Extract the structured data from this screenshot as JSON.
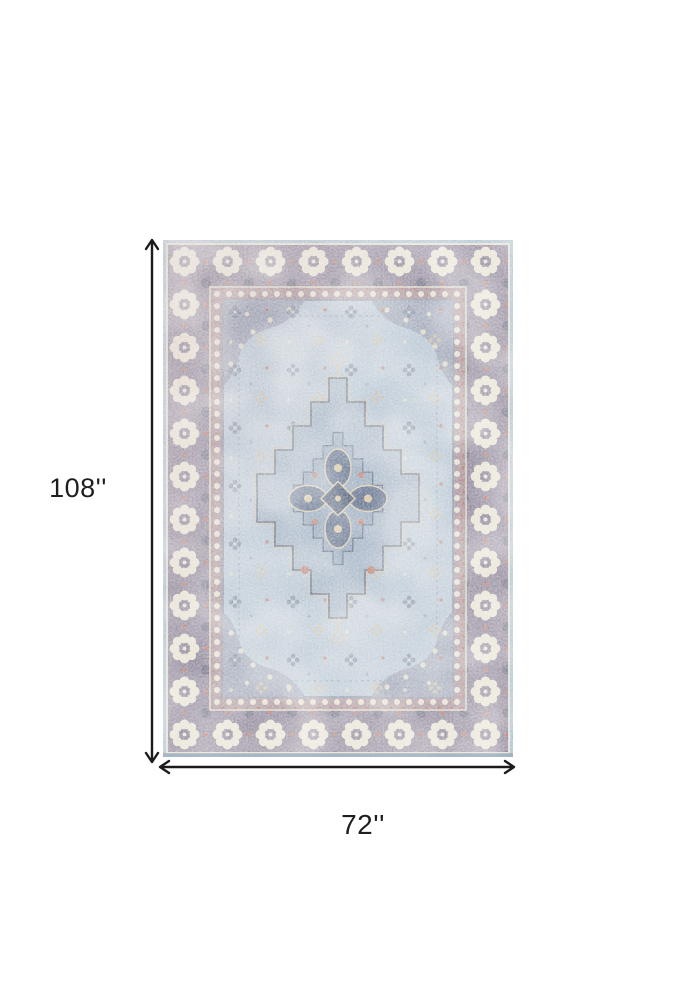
{
  "page": {
    "background_color": "#ffffff"
  },
  "diagram": {
    "subject": "vintage medallion area rug, light blue grey and ivory",
    "height": {
      "label": "108''",
      "value_inches": 108
    },
    "width": {
      "label": "72''",
      "value_inches": 72
    },
    "annotation_color": "#1b1b1b",
    "label_color": "#1e1e1e"
  },
  "rug_palette": {
    "outer_edge_blue": "#a9c0d0",
    "border_ground_mauve": "#8d8499",
    "border_ornament_ivory": "#e8e2d4",
    "guard_stripe": "#a8939b",
    "field_light_blue": "#b5c4d3",
    "spandrel_grey": "#99a0b3",
    "medallion_fill": "#a3b3c6",
    "medallion_outline": "#5d6a82",
    "accent_tan": "#d5c5a3",
    "accent_rust": "#b5796c",
    "accent_slate_blue": "#5f6f8c"
  }
}
